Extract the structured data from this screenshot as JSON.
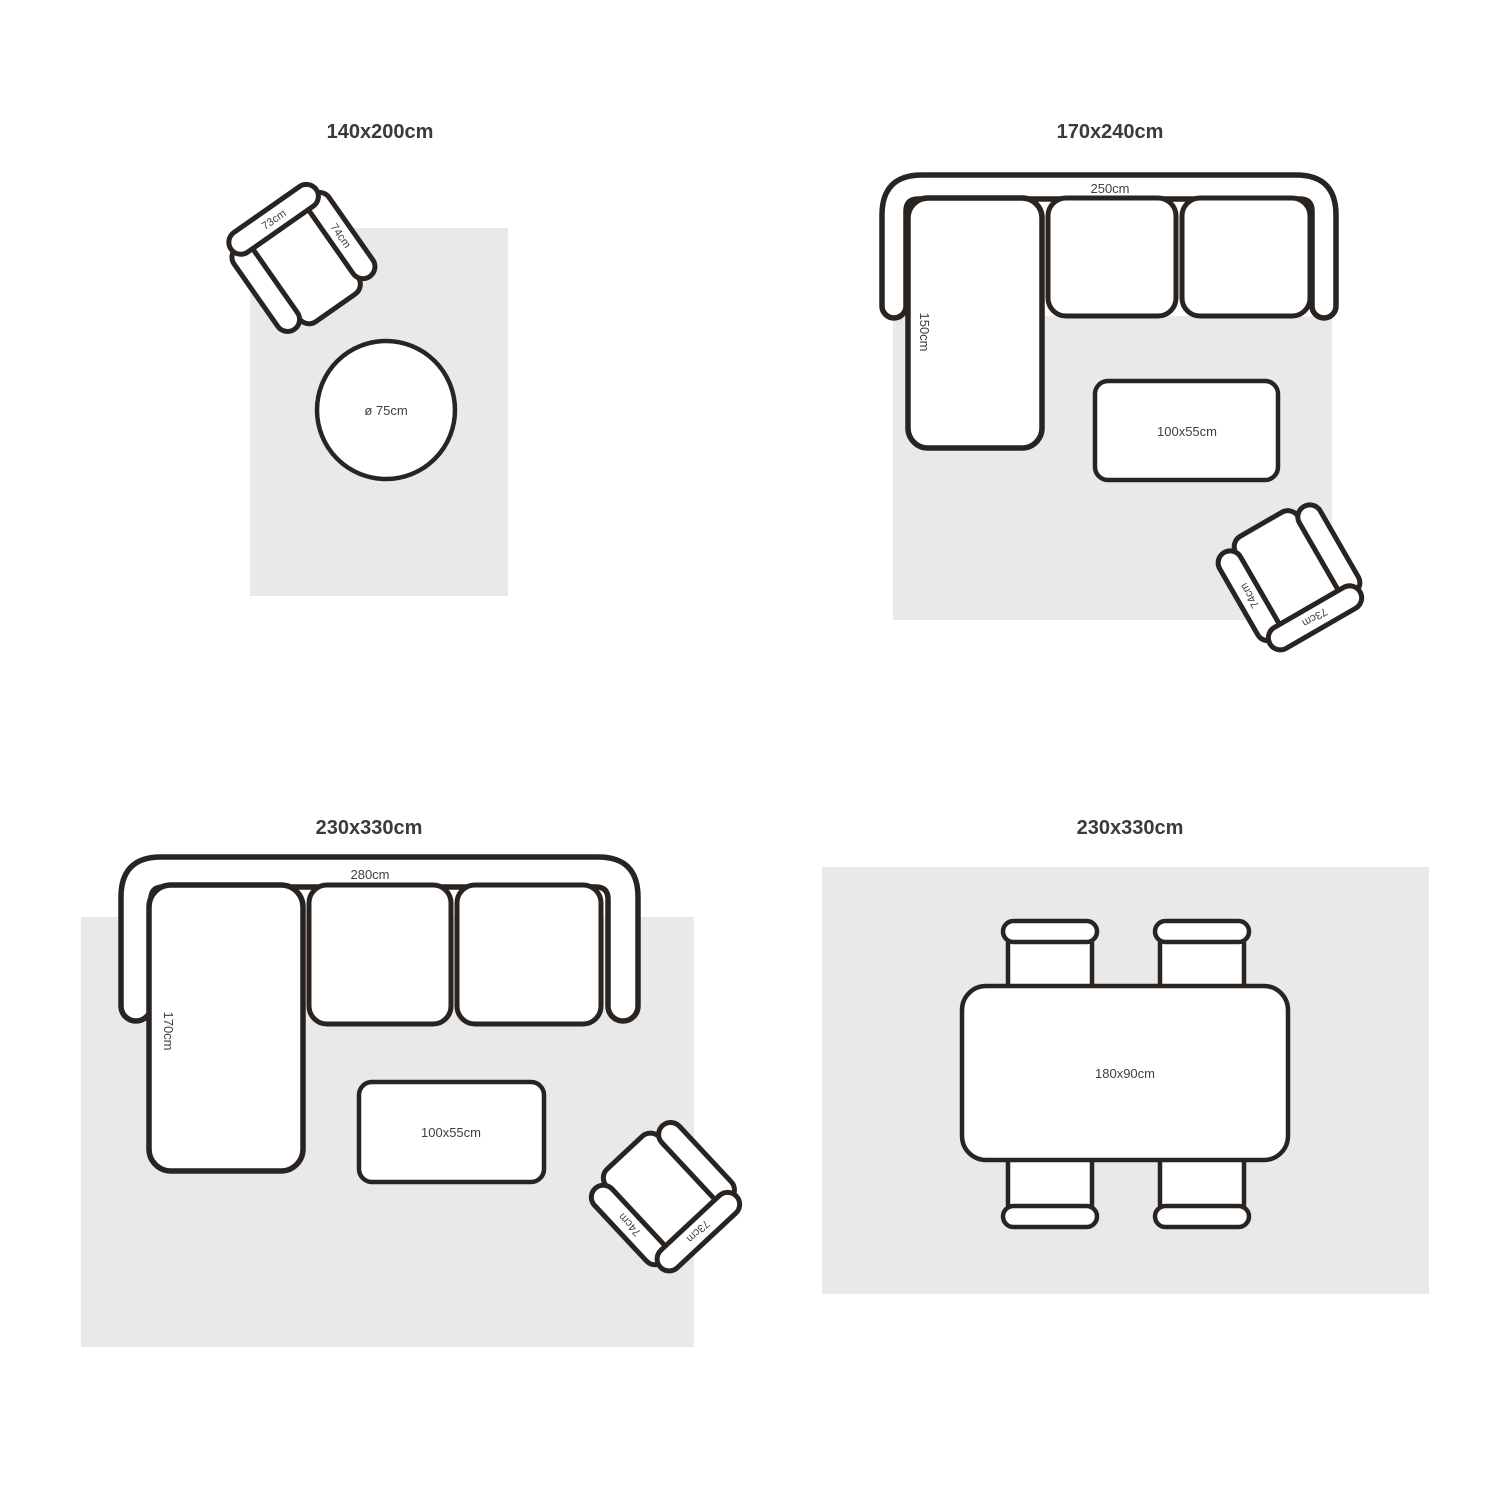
{
  "colors": {
    "background": "#ffffff",
    "outline": "#2a2421",
    "rug_fill": "#e9e9e9",
    "title_text": "#3a3a3a",
    "label_text": "#3f3f3f"
  },
  "quadrants": [
    {
      "id": "top-left",
      "title": "140x200cm",
      "armchair": {
        "back_label": "73cm",
        "side_label": "74cm"
      },
      "round_table": {
        "label": "ø 75cm"
      }
    },
    {
      "id": "top-right",
      "title": "170x240cm",
      "sofa": {
        "width_label": "250cm",
        "depth_label": "150cm"
      },
      "coffee_table": {
        "label": "100x55cm"
      },
      "armchair": {
        "back_label": "73cm",
        "side_label": "74cm"
      }
    },
    {
      "id": "bottom-left",
      "title": "230x330cm",
      "sofa": {
        "width_label": "280cm",
        "depth_label": "170cm"
      },
      "coffee_table": {
        "label": "100x55cm"
      },
      "armchair": {
        "back_label": "73cm",
        "side_label": "74cm"
      }
    },
    {
      "id": "bottom-right",
      "title": "230x330cm",
      "dining_table": {
        "label": "180x90cm"
      }
    }
  ]
}
